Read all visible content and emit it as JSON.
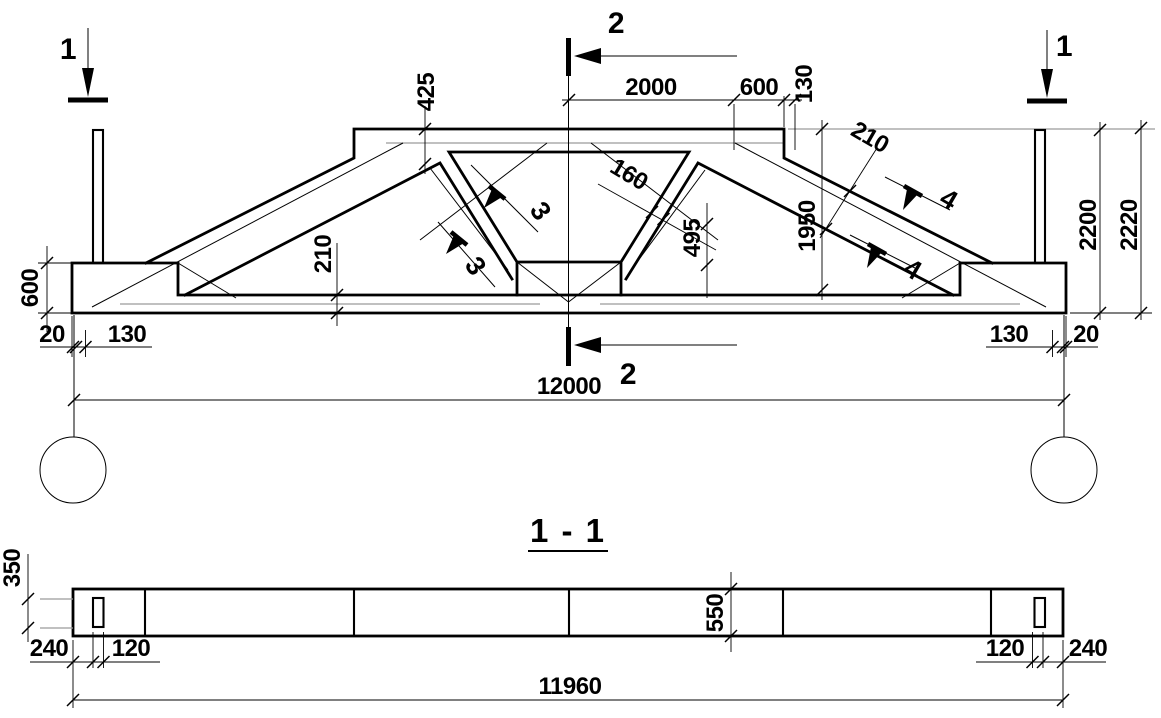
{
  "title_block": {
    "section_view_title": "1 - 1"
  },
  "elevation": {
    "markers": {
      "left": "1",
      "right": "1",
      "top": "2",
      "bottom": "2",
      "diag_upper": "3",
      "diag_lower": "3",
      "chord_upper": "4",
      "chord_lower": "4"
    },
    "dims": {
      "half_span_top": "2000",
      "top_end_seg": "600",
      "top_step": "130",
      "chord_depth": "425",
      "diag_thickness": "160",
      "node_height": "495",
      "web_height": "1950",
      "bottom_chord_thickness": "210",
      "slope_chord_thickness": "210",
      "support_height": "600",
      "end_gap_left": "20",
      "end_offset_left": "130",
      "end_offset_right": "130",
      "end_gap_right": "20",
      "span": "12000",
      "height": "2200",
      "overall_height": "2220"
    }
  },
  "plan": {
    "dims": {
      "slot_length": "350",
      "edge_to_slot_left": "240",
      "slot_width_left": "120",
      "beam_width": "550",
      "slot_width_right": "120",
      "edge_to_slot_right": "240",
      "overall_length": "11960"
    }
  },
  "colors": {
    "line": "#000000",
    "aux_line": "#9a9a9a",
    "background": "#ffffff"
  }
}
